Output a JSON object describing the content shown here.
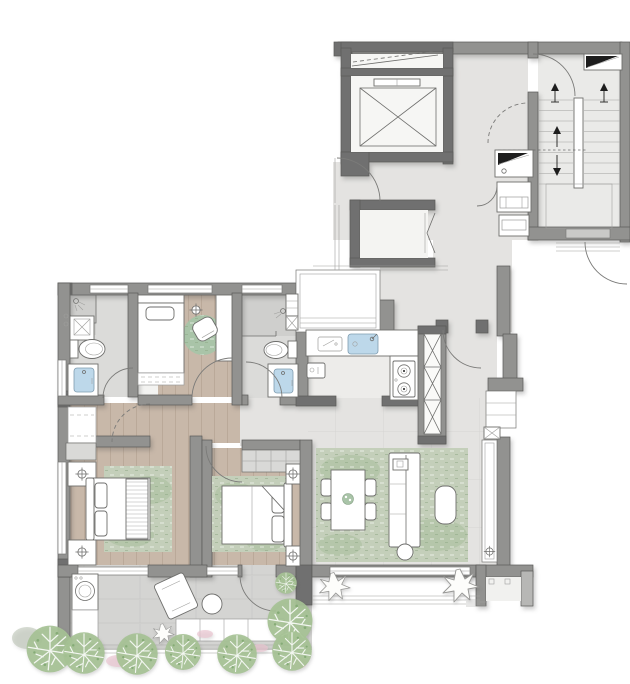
{
  "meta": {
    "type": "architectural-floor-plan",
    "visible_text": [],
    "description": "Residential apartment floor plan with common core (elevator, stairwell) at top right and landscaped balcony at bottom"
  },
  "colors": {
    "wall": "#929290",
    "wallDark": "#707070",
    "stroke": "#5a5a58",
    "marble": "#e4e3e1",
    "stairFloor": "#eaeae8",
    "kitchenFloor": "#edecea",
    "tile": "#dbdbd9",
    "tileDark": "#cfcfcd",
    "wood": "#c8b8a9",
    "stone": "#d4d4d2",
    "rug": "#c4cfba",
    "rugShade": "#a3ba97",
    "roundRug": "#a9c4a8",
    "water": "#bdd8ea",
    "waterStroke": "#7f9cb0",
    "tree": "#a6c294",
    "treeShade": "#7fa871",
    "treeFaint": "#b7bfae",
    "flower": "#e9c4d0",
    "fixtureStroke": "#6e6e6c"
  },
  "plan": {
    "common_areas": [
      {
        "name": "elevator-shaft",
        "features": [
          "elevator-car",
          "duct-space"
        ]
      },
      {
        "name": "elevator-lobby",
        "floor": "marble"
      },
      {
        "name": "stairwell",
        "features": [
          "treads",
          "handrail",
          "direction-arrows",
          "landing",
          "window"
        ]
      },
      {
        "name": "utility-shafts",
        "count": 3,
        "features": [
          "duct-wedge-symbols"
        ]
      },
      {
        "name": "service-closet",
        "features": [
          "bifold-door"
        ]
      }
    ],
    "unit_rooms": [
      {
        "name": "entry-hall",
        "floor": "marble",
        "features": [
          "entry-door"
        ]
      },
      {
        "name": "kitchen",
        "floor": "tile",
        "features": [
          "l-shaped-counter",
          "sink",
          "two-burner-cooktop",
          "cutting-board",
          "small-appliance"
        ]
      },
      {
        "name": "kitchen-bay-window",
        "features": [
          "glazing"
        ]
      },
      {
        "name": "duct-shaft",
        "features": [
          "x-hatch"
        ]
      },
      {
        "name": "bathroom-1",
        "floor": "tile",
        "features": [
          "shower",
          "washbasin",
          "toilet",
          "vanity-sink",
          "window"
        ]
      },
      {
        "name": "study-bedroom",
        "floor": "wood",
        "features": [
          "single-bed",
          "desk",
          "lounge-chair",
          "round-rug",
          "ceiling-lamp",
          "window"
        ]
      },
      {
        "name": "bathroom-2",
        "floor": "tile",
        "features": [
          "shower",
          "washbasin",
          "toilet",
          "vanity-sink"
        ]
      },
      {
        "name": "hallway",
        "floor": "wood-and-marble"
      },
      {
        "name": "master-bedroom",
        "floor": "wood",
        "features": [
          "double-bed",
          "two-nightstands",
          "table-lamps",
          "wardrobe",
          "dresser",
          "area-rug",
          "window"
        ]
      },
      {
        "name": "bedroom-2",
        "floor": "wood",
        "features": [
          "double-bed",
          "wardrobe",
          "two-nightstands",
          "table-lamps",
          "area-rug",
          "window"
        ]
      },
      {
        "name": "living-dining-room",
        "floor": "marble",
        "features": [
          "area-rug",
          "dining-table",
          "four-chairs",
          "sofa",
          "side-table",
          "pouf",
          "floor-drain",
          "window-wall"
        ]
      },
      {
        "name": "balcony",
        "floor": "stone",
        "features": [
          "washing-machine",
          "laundry-counter",
          "lounge-chair",
          "side-table",
          "planter",
          "railing"
        ]
      },
      {
        "name": "ac-platform",
        "features": [
          "equipment-pad"
        ]
      }
    ],
    "landscaping": {
      "trees": 8,
      "shrubs": 3,
      "flower_patches": 5
    }
  }
}
